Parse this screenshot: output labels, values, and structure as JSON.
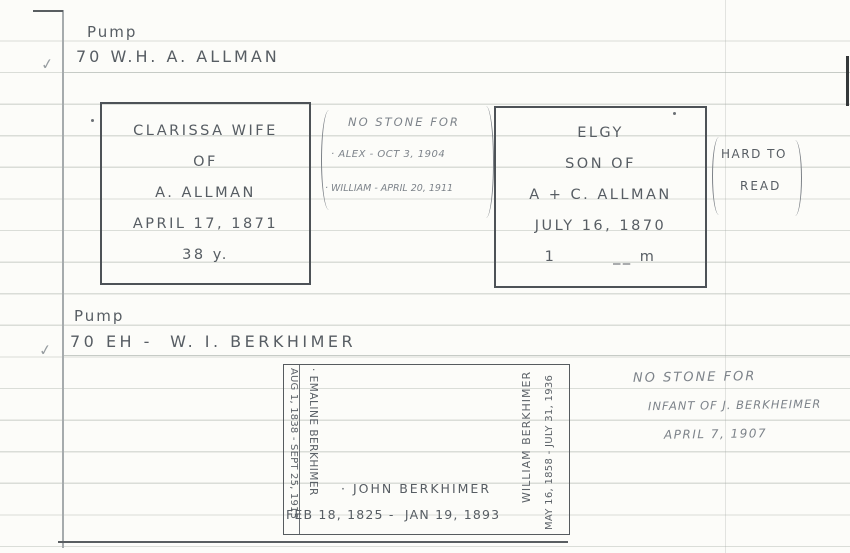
{
  "sections": [
    {
      "checkmark": "✓",
      "heading": {
        "line1": "Pump",
        "line2": "70 W.H. A. ALLMAN"
      },
      "stone_clarissa": {
        "lines": [
          "CLARISSA WIFE",
          "OF",
          "A. ALLMAN",
          "APRIL 17, 1871",
          "38 y."
        ]
      },
      "no_stone_note": {
        "lines": [
          "NO STONE FOR",
          "· ALEX - OCT 3, 1904",
          "· WILLIAM - APRIL 20, 1911"
        ]
      },
      "stone_elgy": {
        "lines": [
          "ELGY",
          "SON OF",
          "A + C. ALLMAN",
          "JULY 16, 1870",
          "1        __ m"
        ]
      },
      "side_note": {
        "line1": "HARD TO",
        "line2": "READ"
      }
    },
    {
      "checkmark": "✓",
      "heading": {
        "line1": "Pump",
        "line2": "70 EH -  W. I. BERKHIMER"
      },
      "stone_berkhimer": {
        "left_dates": "AUG 1, 1838 - SEPT 25, 1915",
        "left_name": "· EMALINE BERKHIMER",
        "right_name": "WILLIAM BERKHIMER",
        "right_dates": "MAY 16, 1858 - JULY 31, 1936",
        "bottom_name": "· JOHN BERKHIMER",
        "bottom_dates": "FEB 18, 1825 -  JAN 19, 1893"
      },
      "no_stone_note": {
        "lines": [
          "NO STONE FOR",
          "INFANT OF J. BERKHEIMER",
          "APRIL 7, 1907"
        ]
      }
    }
  ]
}
